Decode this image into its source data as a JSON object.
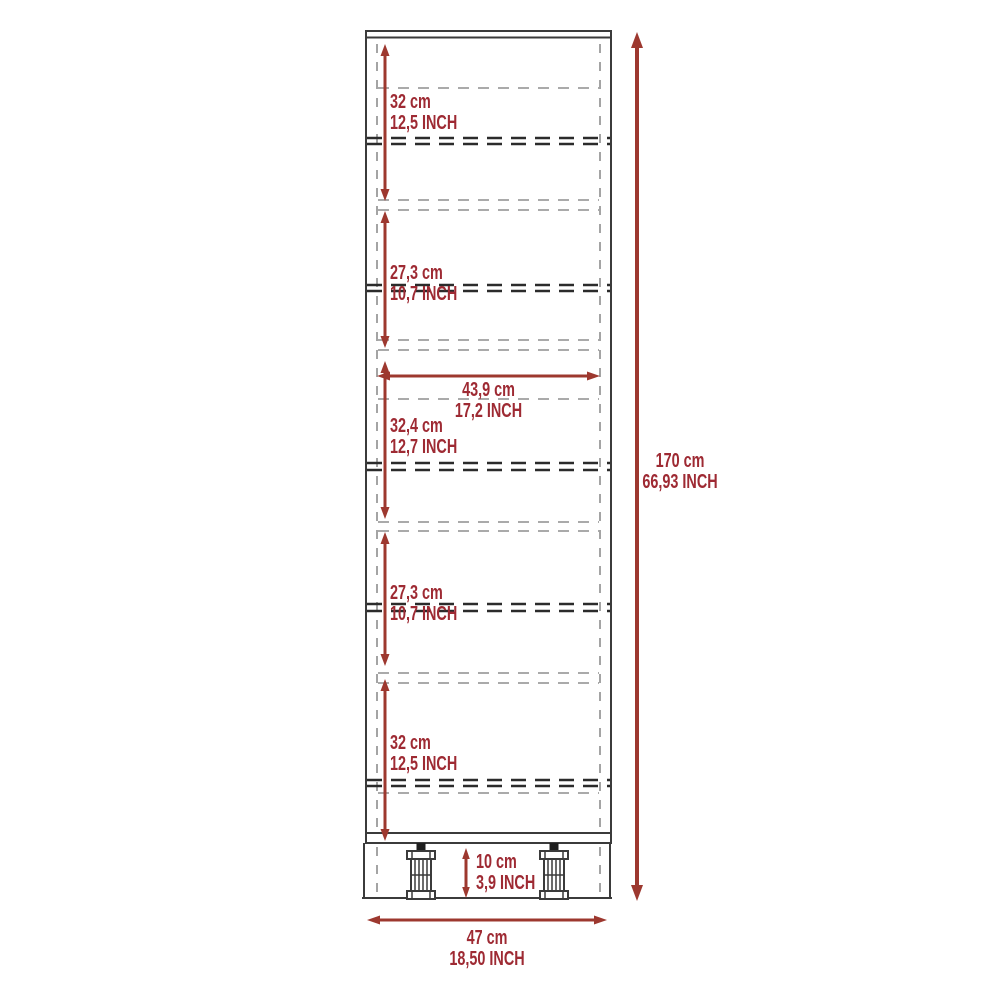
{
  "diagram": {
    "kind": "furniture-dimension-drawing",
    "subject": "tall 5-compartment cabinet with legs, front view with dashed shelf lines"
  },
  "colors": {
    "background": "#ffffff",
    "dimension_red": "#9e2a33",
    "arrow_red": "#9d382f",
    "outline_dark": "#3b3b3b",
    "dash_gray": "#8e8e8e",
    "shelf_dark": "#2b2b2b",
    "leg_dark": "#1e1e1e"
  },
  "labels": {
    "sections": [
      {
        "cm": "32 cm",
        "inch": "12,5 INCH"
      },
      {
        "cm": "27,3 cm",
        "inch": "10,7 INCH"
      },
      {
        "cm": "32,4 cm",
        "inch": "12,7 INCH"
      },
      {
        "cm": "27,3 cm",
        "inch": "10,7 INCH"
      },
      {
        "cm": "32 cm",
        "inch": "12,5 INCH"
      }
    ],
    "inner_width": {
      "cm": "43,9 cm",
      "inch": "17,2 INCH"
    },
    "height": {
      "cm": "170 cm",
      "inch": "66,93 INCH"
    },
    "legs": {
      "cm": "10 cm",
      "inch": "3,9 INCH"
    },
    "width": {
      "cm": "47 cm",
      "inch": "18,50 INCH"
    }
  }
}
